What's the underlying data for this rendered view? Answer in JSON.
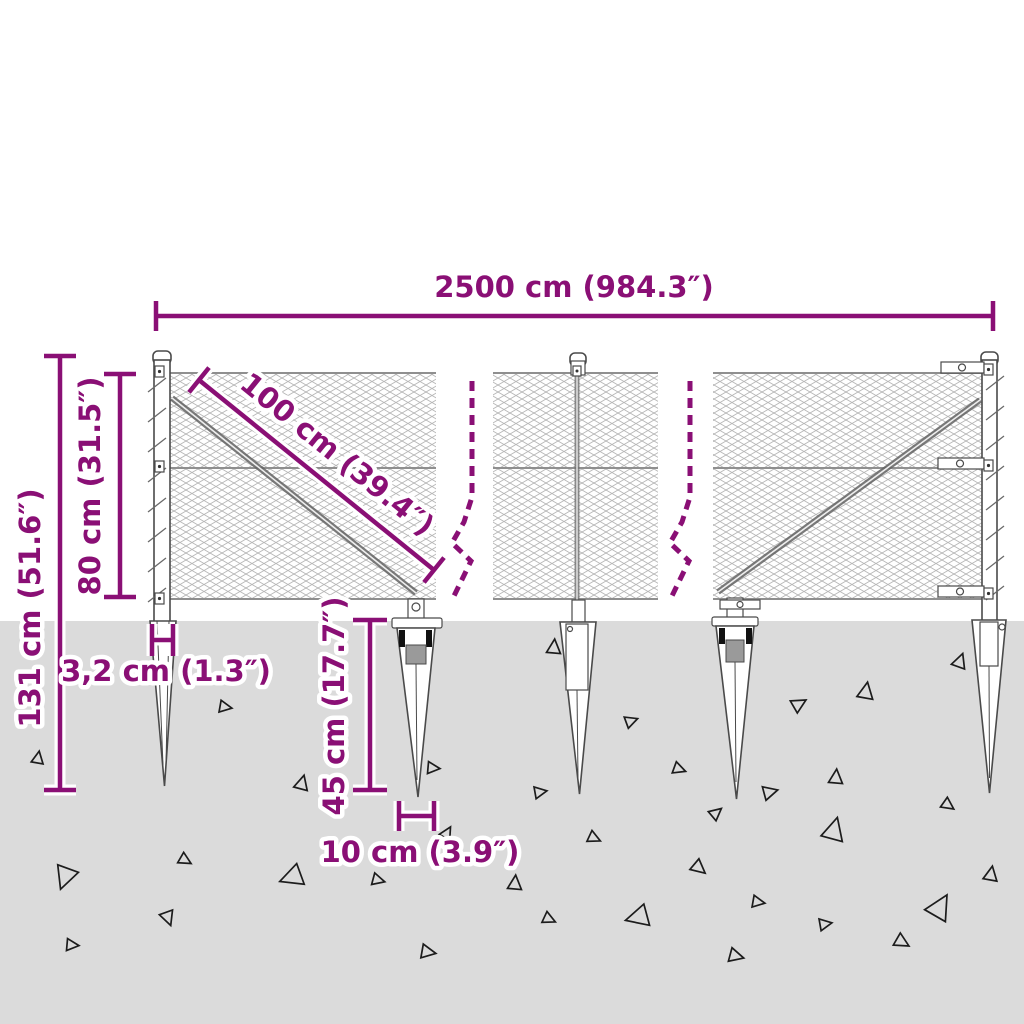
{
  "diagram": {
    "type": "product-dimension-diagram",
    "subject": "wire mesh fence with ground anchor spikes"
  },
  "dimensions": {
    "total_width": "2500 cm (984.3″)",
    "panel_diagonal": "100 cm (39.4″)",
    "mesh_height": "80 cm (31.5″)",
    "total_height": "131 cm (51.6″)",
    "post_width": "3,2 cm (1.3″)",
    "anchor_depth": "45 cm (17.7″)",
    "anchor_width": "10 cm (3.9″)"
  },
  "colors": {
    "dimension_purple": "#8A0F75",
    "ground_gray": "#DBDBDB",
    "drawing_line": "#4A4A4A",
    "mesh_line": "#B6B6B6"
  }
}
